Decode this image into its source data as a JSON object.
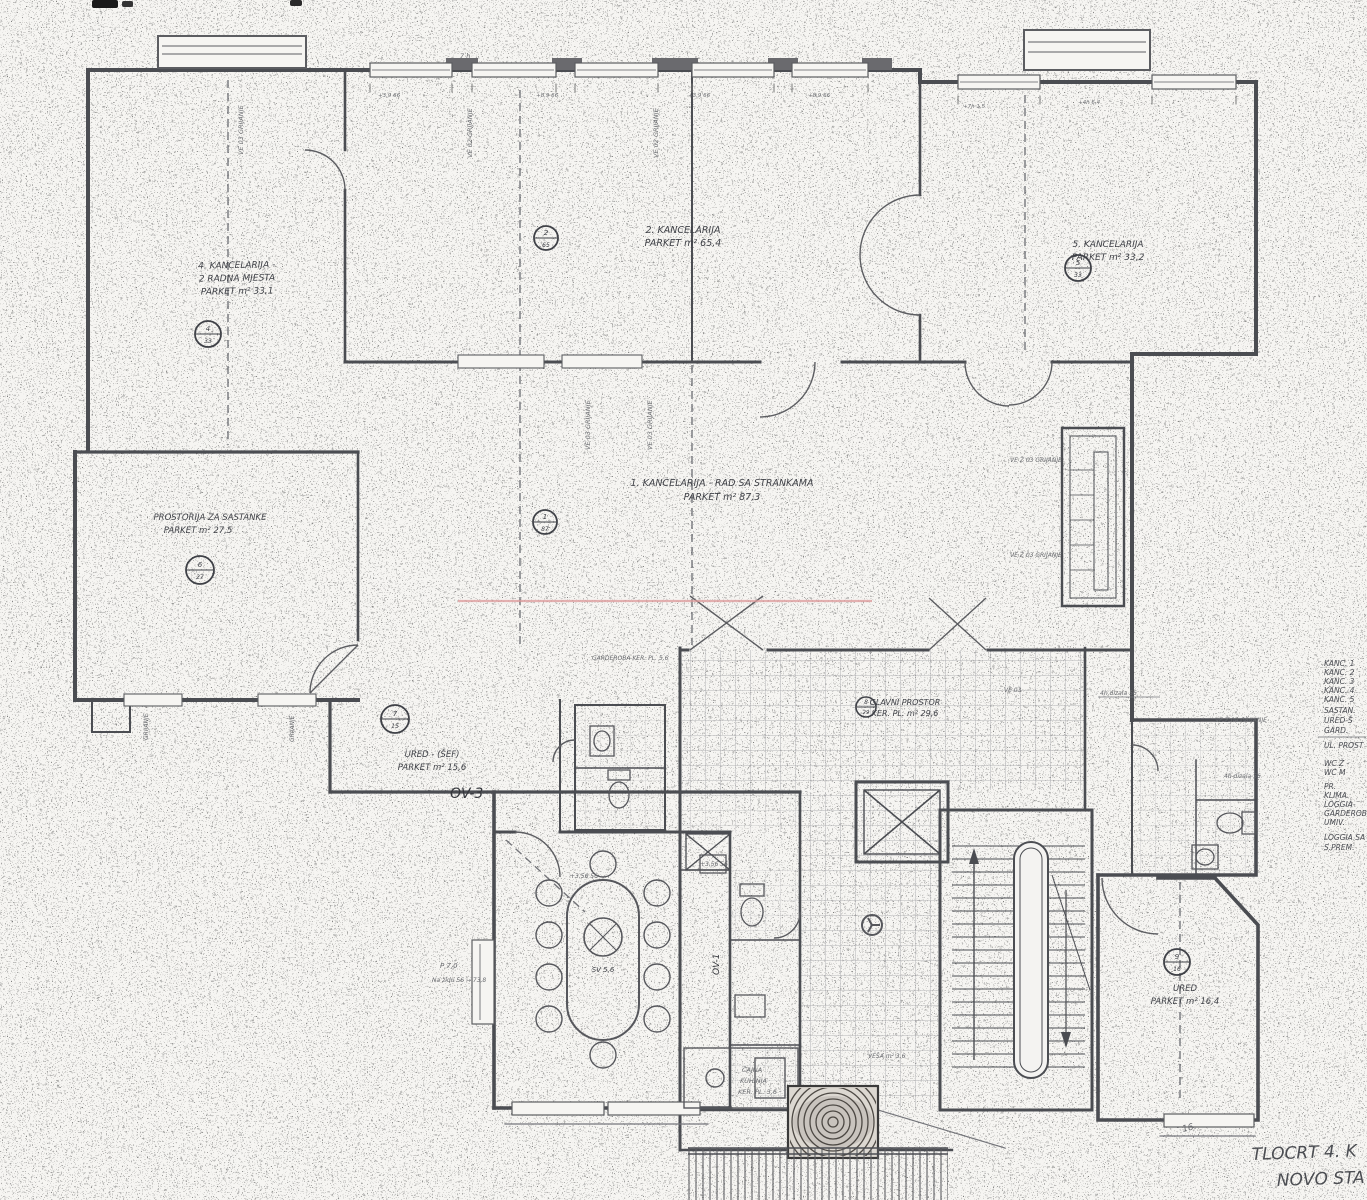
{
  "title": {
    "line1": "TLOCRT 4. K",
    "line2": "NOVO STA",
    "page_mark": "16."
  },
  "legend": {
    "items": [
      "KANC. 1",
      "KANC. 2",
      "KANC. 3",
      "KANC. 4",
      "KANC. 5",
      "SASTAN.",
      "URED-Š",
      "GARD.",
      "UL. PROST",
      "WC Ž -",
      "WC M",
      "PR.",
      "KLIMA.",
      "LOGGIA-",
      "GARDEROB",
      "UMIV.",
      "LOGGIA SA",
      "S.PREM."
    ]
  },
  "rooms": [
    {
      "name": "kancelarija-4",
      "label_lines": [
        "4. KANCELARIJA -",
        "2 RADNA MJESTA",
        "PARKET m² 33,1"
      ],
      "badge": {
        "top": "4",
        "bot": "33"
      }
    },
    {
      "name": "kancelarija-2",
      "label_lines": [
        "2. KANCELARIJA",
        "PARKET m² 65,4"
      ],
      "badge": {
        "top": "2",
        "bot": "65"
      }
    },
    {
      "name": "kancelarija-5",
      "label_lines": [
        "5. KANCELARIJA",
        "PARKET m² 33,2"
      ],
      "badge": {
        "top": "5",
        "bot": "33"
      }
    },
    {
      "name": "kancelarija-1",
      "label_lines": [
        "1. KANCELARIJA - RAD SA STRANKAMA",
        "PARKET m² 87,3"
      ],
      "badge": {
        "top": "1",
        "bot": "87"
      }
    },
    {
      "name": "prostorija-za-sastanke",
      "label_lines": [
        "PROSTORIJA ZA SASTANKE",
        "PARKET m² 27,5"
      ],
      "badge": {
        "top": "6",
        "bot": "27"
      }
    },
    {
      "name": "ured-sef",
      "label_lines": [
        "URED - (ŠEF)",
        "PARKET m² 15,6"
      ],
      "badge": {
        "top": "7",
        "bot": "15"
      }
    },
    {
      "name": "glavni-prostor",
      "label_lines": [
        "GLAVNI PROSTOR",
        "KER. PL. m² 29,6"
      ],
      "badge": {
        "top": "8",
        "bot": "29"
      }
    },
    {
      "name": "ured-dolje",
      "label_lines": [
        "URED",
        "PARKET m² 16,4"
      ],
      "badge": {
        "top": "9",
        "bot": "16"
      }
    },
    {
      "name": "blagovaona",
      "table_label": "SV 5,6"
    }
  ],
  "annotations": [
    "VE 03 GRIJANJE",
    "VE 02 GRIJANJE",
    "VE 02 GRIJANJE",
    "VE 03 GRIJANJE",
    "VE 03 GRIJANJE",
    "VE Ž 03 GRIJANJE",
    "VE Ž 03 GRIJANJE",
    "VE Ž 04 GRIJANJE",
    "GRIJANJE",
    "GRIJANJE",
    "OV-3",
    "OV-1",
    "+3,56  56",
    "+3,56  56",
    "P 7,0",
    "Na zidu 56 → 73,8",
    "ČAJNA",
    "KUHINJA",
    "KER. PL. 3,6",
    "VEŠA m² 3,6",
    "4h dizala 56",
    "4h dizala 56",
    "GARDEROBA  KER. PL. 5,6",
    "7 h",
    "+3,9 66",
    "+8,9 66",
    "+3,9 66",
    "+8,9 66",
    "+7h 1,5",
    "+4h 6,4",
    "VE 03"
  ],
  "colors": {
    "ink": "#4b4d52",
    "light_ink": "#75767b",
    "red_marker": "#dd9a9a",
    "paper": "#f6f5f2"
  }
}
